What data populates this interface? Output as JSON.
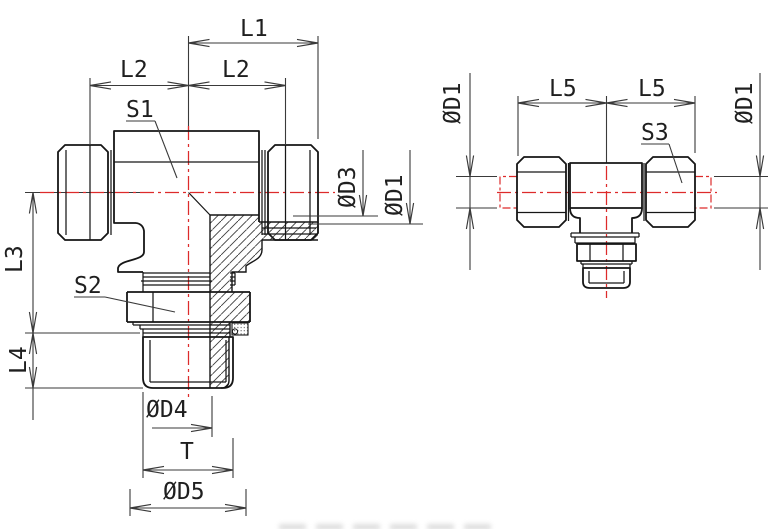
{
  "drawing": {
    "type": "technical-drawing-tee-fitting",
    "colors": {
      "outline": "#161616",
      "dimension": "#3a3a3a",
      "centerline": "#dd2b2b",
      "hatch": "#3c3c3c"
    },
    "front_view": {
      "dims": {
        "l1": "L1",
        "l2_left": "L2",
        "l2_right": "L2",
        "l3": "L3",
        "l4": "L4",
        "d3": "ØD3",
        "d1": "ØD1",
        "d4": "ØD4",
        "t": "T",
        "d5": "ØD5"
      },
      "callouts": {
        "s1": "S1",
        "s2": "S2"
      }
    },
    "side_view": {
      "dims": {
        "d1_left": "ØD1",
        "l5_left": "L5",
        "l5_right": "L5",
        "d1_right": "ØD1"
      },
      "callouts": {
        "s3": "S3"
      }
    }
  }
}
